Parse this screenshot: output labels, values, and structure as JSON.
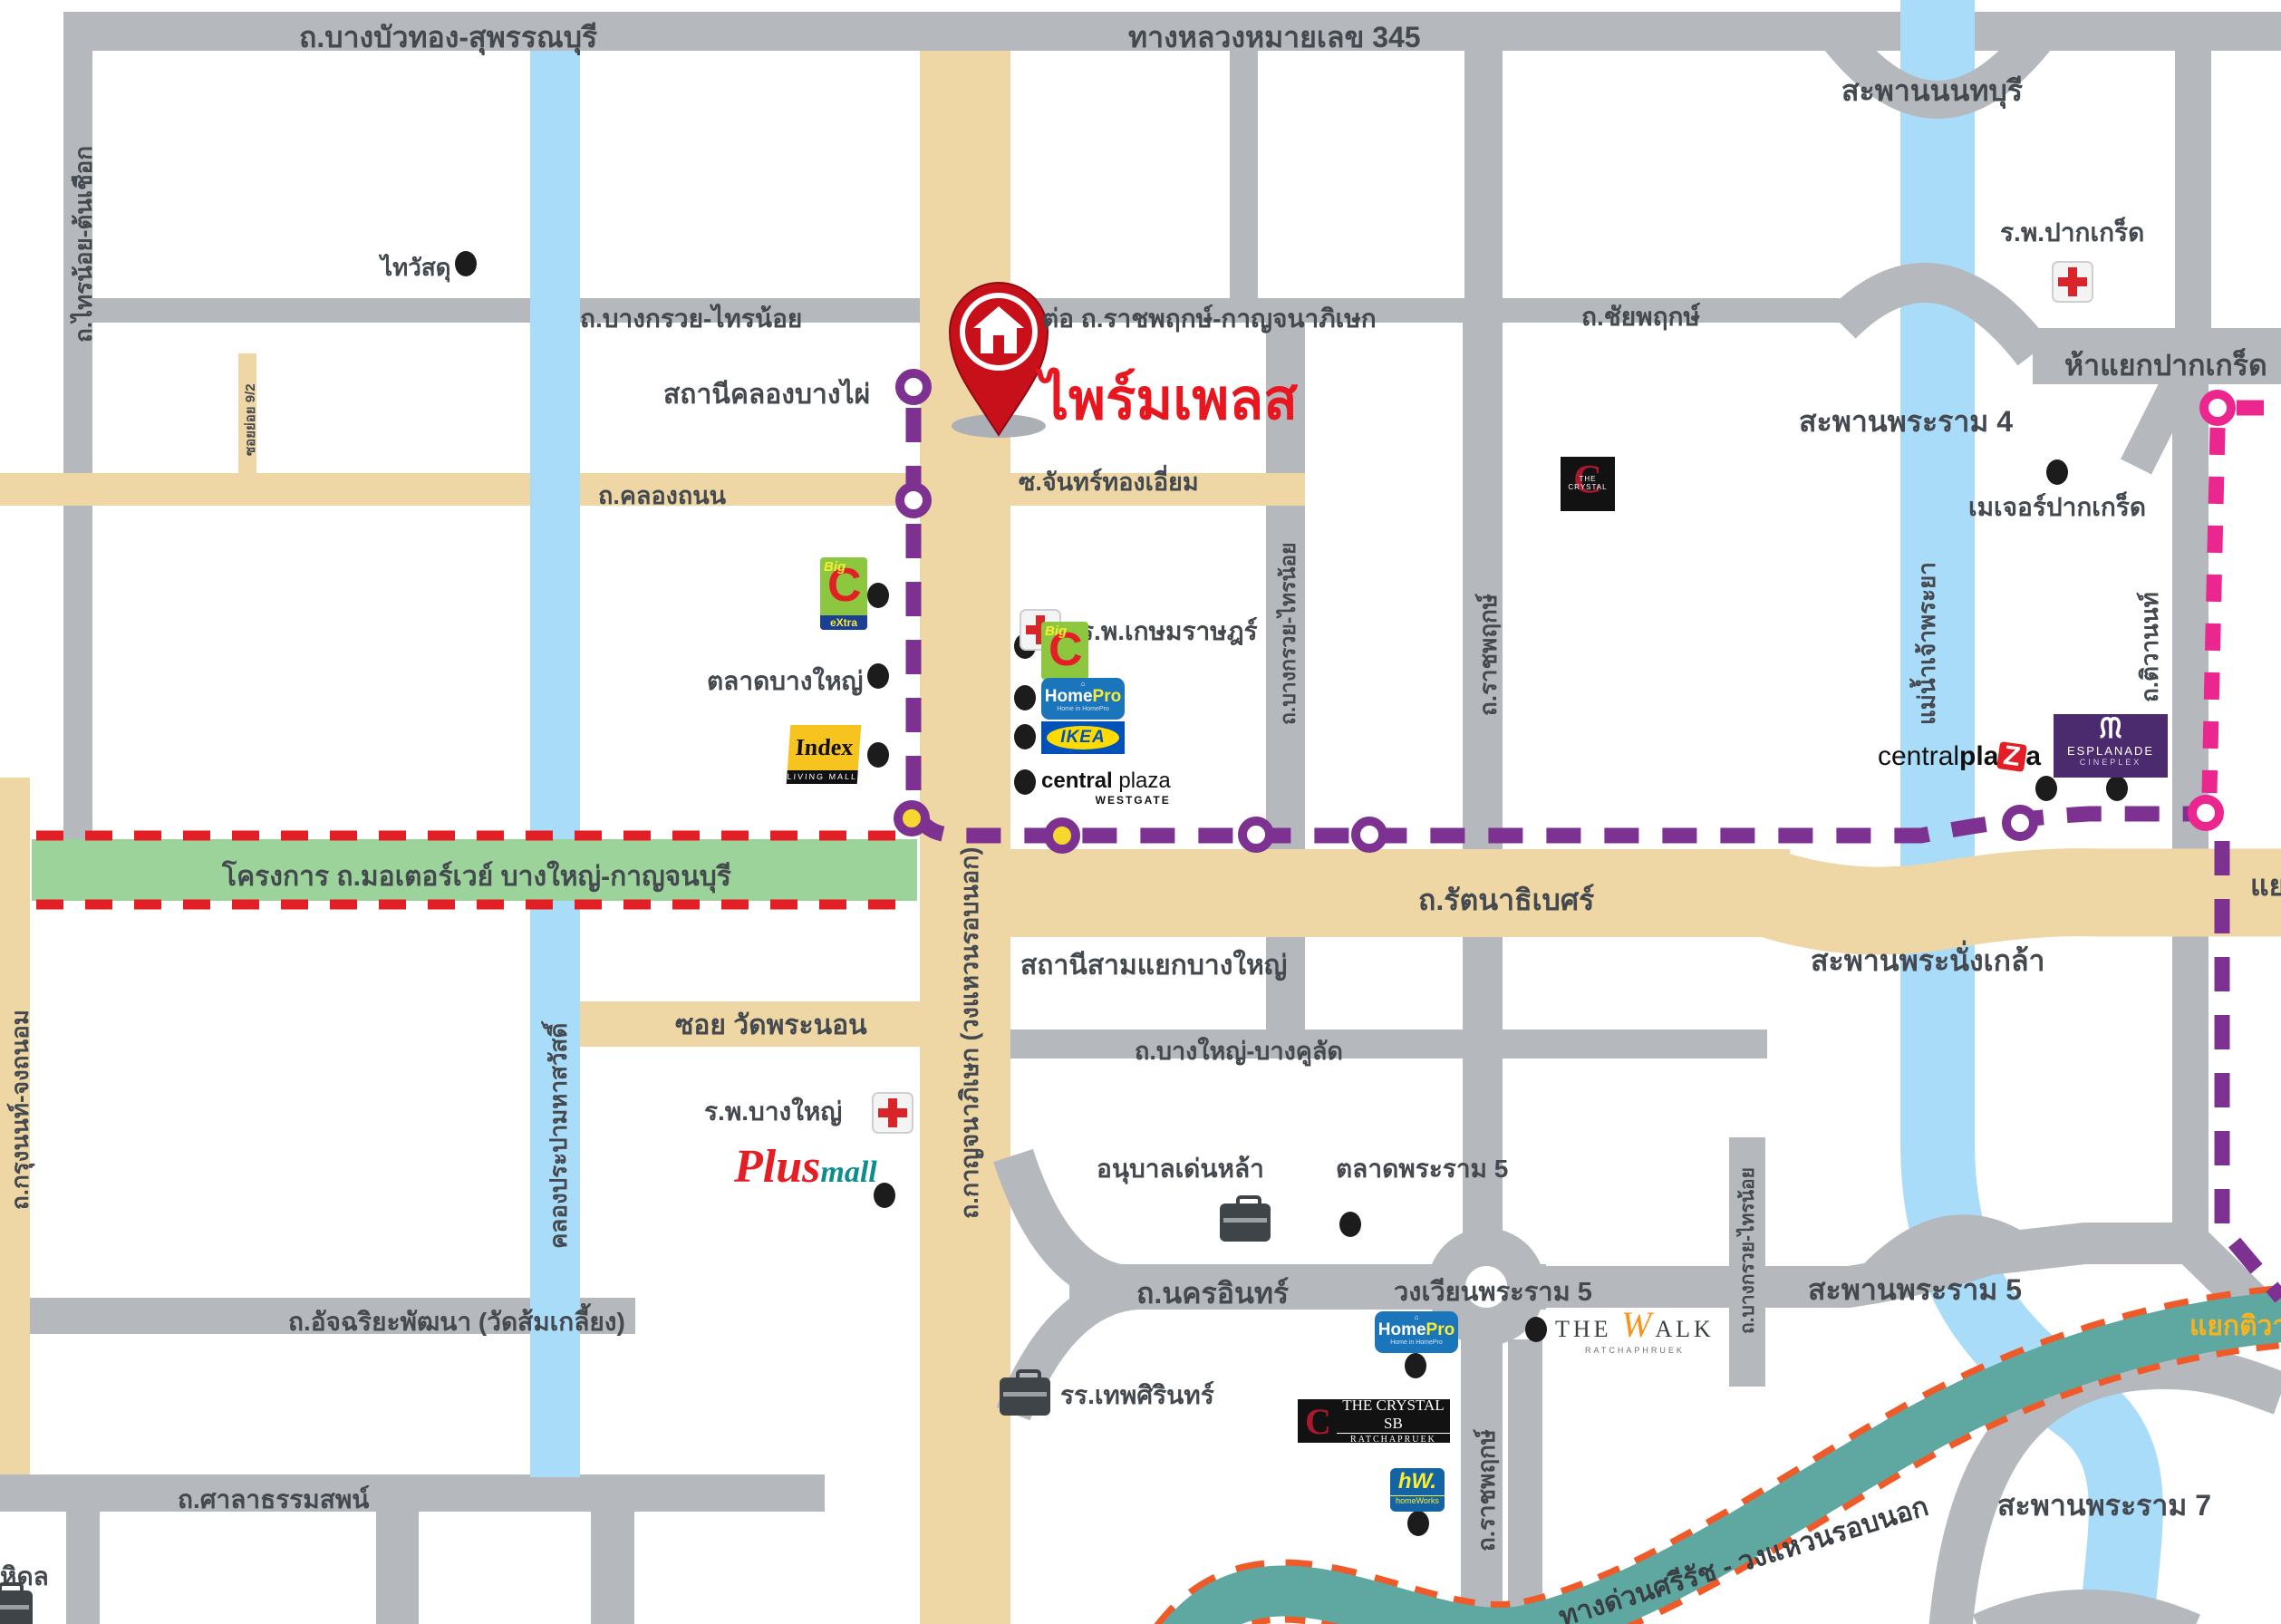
{
  "pin": {
    "title": "ไพร์มเพลส"
  },
  "colors": {
    "road_gray": "#b5b9bd",
    "road_tan": "#eed7a4",
    "water": "#a9dcf8",
    "green_project": "#9cd39a",
    "red_dash": "#e31e24",
    "purple_line": "#7d3190",
    "station_yellow": "#f6d72f",
    "pink_line": "#ec268f",
    "expressway_teal": "#5fa7a1",
    "expressway_dash": "#f05a28",
    "pin_red": "#d31920",
    "label_text": "#44494f"
  },
  "labels": {
    "bangbuathong": "ถ.บางบัวทอง-สุพรรณบุรี",
    "highway345": "ทางหลวงหมายเลข 345",
    "sainoi_toncheuak": "ถ.ไทรน้อย-ต้นเชือก",
    "bangkruai_sainoi": "ถ.บางกรวย-ไทรน้อย",
    "ratchaphruek_ext": "ต่อ ถ.ราชพฤกษ์-กาญจนาภิเษก",
    "chaiyaphruek": "ถ.ชัยพฤกษ์",
    "saphan_nonthaburi": "สะพานนนทบุรี",
    "rp_pakkret": "ร.พ.ปากเกร็ด",
    "hayaek_pakkret": "ห้าแยกปากเกร็ด",
    "saphan_rama4": "สะพานพระราม 4",
    "thaiwatsadu": "ไทวัสดุ",
    "soi_yoi": "ซอยย่อย 9/2",
    "khlong_thanon": "ถ.คลองถนน",
    "station_khlong_bangphai": "สถานีคลองบางไผ่",
    "soi_chanthong_iam": "ซ.จันทร์ทองเอี่ยม",
    "major_pakkret": "เมเจอร์ปากเกร็ด",
    "rp_kasemrad": "ร.พ.เกษมราษฎร์",
    "talad_bangyai": "ตลาดบางใหญ่",
    "motorway": "โครงการ ถ.มอเตอร์เวย์ บางใหญ่-กาญจนบุรี",
    "rattanathibet": "ถ.รัตนาธิเบศร์",
    "station_samyaek_bangyai": "สถานีสามแยกบางใหญ่",
    "saphan_phranangklao": "สะพานพระนั่งเกล้า",
    "yaek_khaerai": "แยกแคราย",
    "kanchanaphisek": "ถ.กาญจนาภิเษก (วงแหวนรอบนอก)",
    "ratchaphruek": "ถ.ราชพฤกษ์",
    "tiwanon": "ถ.ติวานนท์",
    "chaophraya": "แม่น้ำเจ้าพระยา",
    "soi_watphranon": "ซอย วัดพระนอน",
    "khlong_prapa": "คลองประปามหาสวัสดิ์",
    "rp_bangyai": "ร.พ.บางใหญ่",
    "bangyai_bangkhulat": "ถ.บางใหญ่-บางคูลัด",
    "anuban_denla": "อนุบาลเด่นหล้า",
    "talad_rama5": "ตลาดพระราม 5",
    "nakhon_in": "ถ.นครอินทร์",
    "wongwian_rama5": "วงเวียนพระราม 5",
    "saphan_rama5": "สะพานพระราม 5",
    "atchariya": "ถ.อัจฉริยะพัฒนา (วัดส้มเกลี้ยง)",
    "thepsirin": "รร.เทพศิรินทร์",
    "krungnon": "ถ.กรุงนนท์-จงถนอม",
    "saladhammasop": "ถ.ศาลาธรรมสพน์",
    "mahidol": "หิดล",
    "saphan_rama7": "สะพานพระราม 7",
    "srirat": "ทางด่วนศรีรัช - วงแหวนรอบนอก",
    "yaek_tiwanon": "แยกติวานนท์"
  },
  "logos": {
    "bigc_big": "Big",
    "bigc_c": "C",
    "bigc_extra": "eXtra",
    "index_name": "Index",
    "index_sub": "LIVING MALL",
    "homepro_home": "Home",
    "homepro_pro": "Pro",
    "homepro_tag": "Home in HomePro",
    "ikea": "IKEA",
    "cpw_central": "central",
    "cpw_plaza": " plaza",
    "cpw_sub": "WESTGATE",
    "crystal_c": "C",
    "crystal_name": "THE CRYSTAL",
    "cpz_central": "central",
    "cpz_pla": "pla",
    "cpz_z": "Z",
    "cpz_a": "a",
    "espl_name": "ESPLANADE",
    "espl_sub": "CINEPLEX",
    "plus": "Plus",
    "mall": "mall",
    "walk_the": "THE ",
    "walk_w": "W",
    "walk_alk": "ALK",
    "walk_sub": "RATCHAPHRUEK",
    "csb_c": "C",
    "csb_name": "THE CRYSTAL SB",
    "csb_sub": "RATCHAPRUEK",
    "hw_name": "hW.",
    "hw_sub": "homeWorks"
  }
}
